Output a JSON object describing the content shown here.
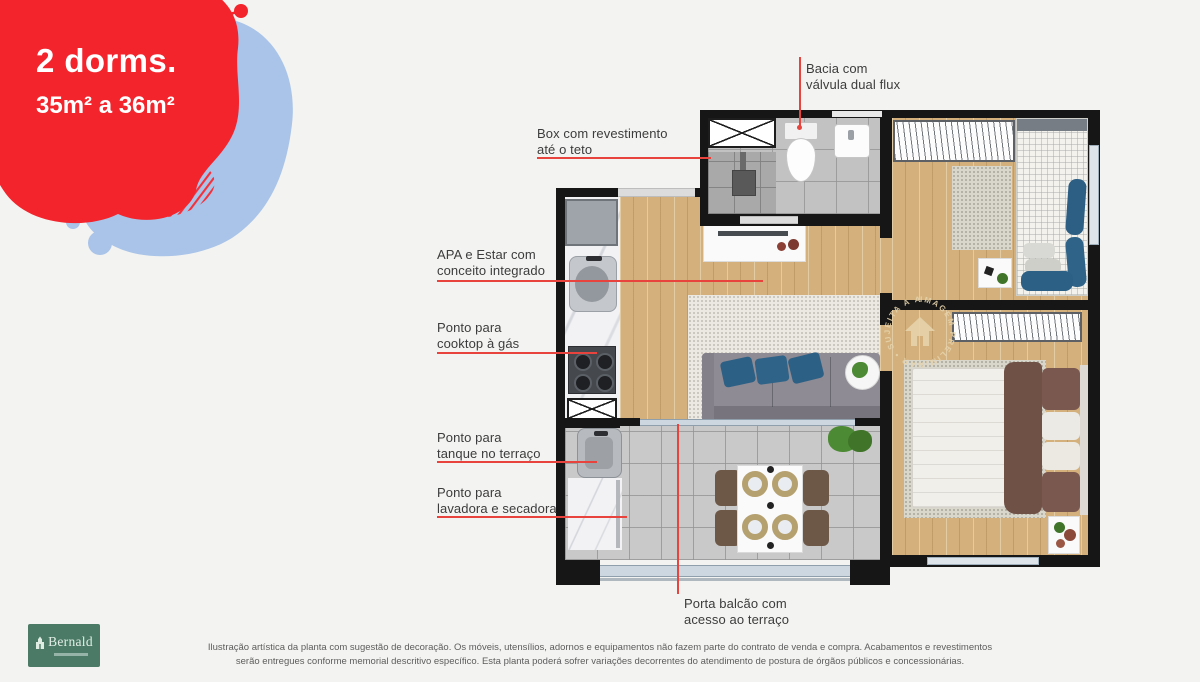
{
  "unit_badge": {
    "title": "2 dorms.",
    "area_range": "35m² a 36m²"
  },
  "annotations": {
    "bacia": {
      "line1": "Bacia com",
      "line2": "válvula dual flux"
    },
    "box": {
      "line1": "Box com revestimento",
      "line2": "até o teto"
    },
    "apa": {
      "line1": "APA e Estar com",
      "line2": "conceito integrado"
    },
    "cooktop": {
      "line1": "Ponto para",
      "line2": "cooktop à gás"
    },
    "tanque": {
      "line1": "Ponto para",
      "line2": "tanque no terraço"
    },
    "lavadora": {
      "line1": "Ponto para",
      "line2": "lavadora e secadora"
    },
    "porta": {
      "line1": "Porta balcão com",
      "line2": "acesso ao terraço"
    }
  },
  "watermark_text": "IMAGEM PRELIMINAR • SUJEITA A ALTERAÇÕES •",
  "logo_text": "Bernald",
  "disclaimer": {
    "line1": "Ilustração artística da planta com sugestão de decoração. Os móveis, utensílios, adornos e equipamentos não fazem parte do contrato de venda e compra. Acabamentos e revestimentos",
    "line2": "serão entregues conforme memorial descritivo específico. Esta planta poderá sofrer variações decorrentes do atendimento de postura de órgãos públicos e concessionárias."
  },
  "colors": {
    "accent_red": "#f4242c",
    "accent_blue": "#a9c4e8",
    "annotation_red": "#e8433c",
    "logo_green": "#4b7a66"
  }
}
